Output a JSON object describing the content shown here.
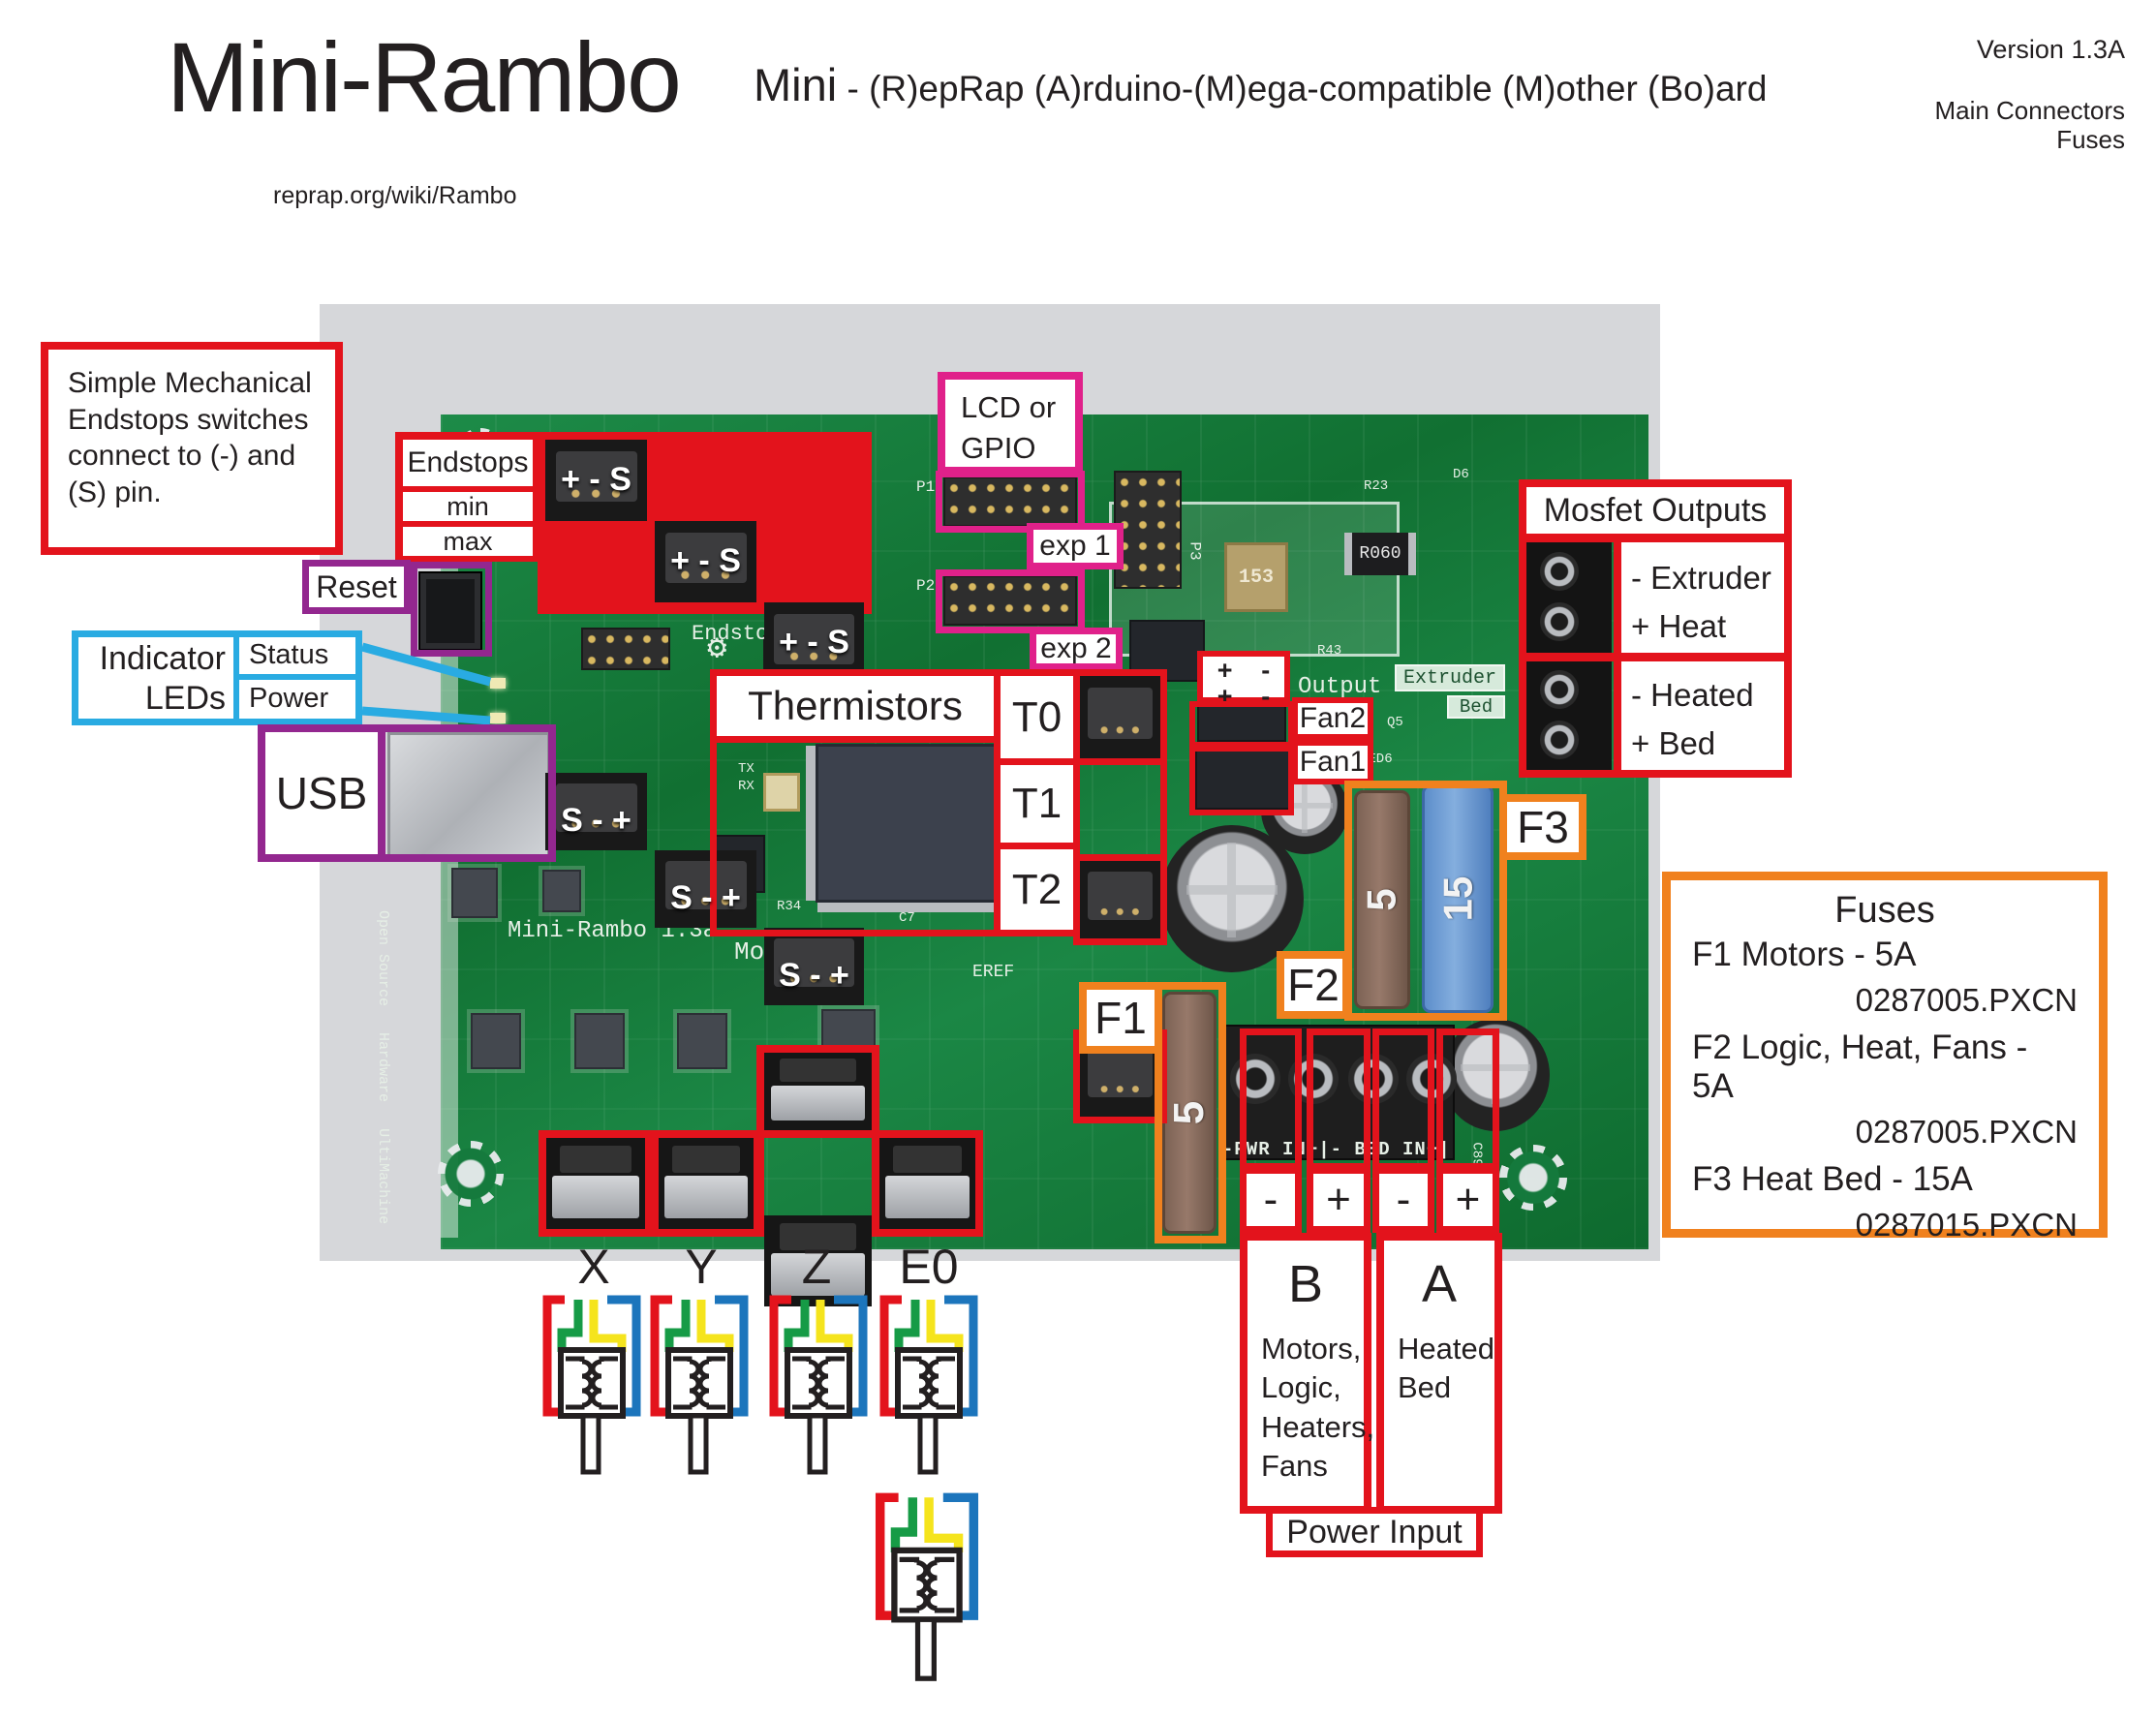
{
  "header": {
    "title": "Mini-Rambo",
    "url": "reprap.org/wiki/Rambo",
    "subtitle_lead": "Mini",
    "subtitle_rest": " - (R)epRap (A)rduino-(M)ega-compatible (M)other (Bo)ard",
    "version": "Version 1.3A",
    "corner_line1": "Main Connectors",
    "corner_line2": "Fuses"
  },
  "colors": {
    "annotation_red": "#e3131c",
    "annotation_pink": "#e0218a",
    "annotation_purple": "#93278f",
    "annotation_blue": "#29abe2",
    "annotation_orange": "#f0811e",
    "board_green": "#15793c",
    "wire_red": "#e3131c",
    "wire_green": "#169b46",
    "wire_yellow": "#f5e41d",
    "wire_blue": "#1c75bc"
  },
  "note": {
    "text": "Simple Mechanical Endstops switches connect to (-) and (S) pin."
  },
  "endstops": {
    "title": "Endstops",
    "row_min": "min",
    "row_max": "max",
    "pins_top": "+ - S",
    "pins_bottom": "S - +"
  },
  "lcd": {
    "line1": "LCD or",
    "line2": "GPIO",
    "exp1": "exp 1",
    "exp2": "exp 2"
  },
  "reset": {
    "label": "Reset"
  },
  "indicator": {
    "line1": "Indicator",
    "line2": "LEDs",
    "status": "Status",
    "power": "Power"
  },
  "usb": {
    "label": "USB"
  },
  "thermistors": {
    "title": "Thermistors",
    "t0": "T0",
    "t1": "T1",
    "t2": "T2"
  },
  "fans": {
    "fan1": "Fan1",
    "fan2": "Fan2",
    "plus": "+",
    "minus": "-"
  },
  "mosfet": {
    "title": "Mosfet Outputs",
    "row1_line1": "- Extruder",
    "row1_line2": "+ Heat",
    "row2_line1": "- Heated",
    "row2_line2": "+ Bed"
  },
  "fuse_tags": {
    "f1": "F1",
    "f2": "F2",
    "f3": "F3"
  },
  "fuses_legend": {
    "title": "Fuses",
    "items": [
      {
        "name": "F1 Motors - 5A",
        "part": "0287005.PXCN"
      },
      {
        "name": "F2 Logic, Heat, Fans - 5A",
        "part": "0287005.PXCN"
      },
      {
        "name": "F3 Heat Bed - 15A",
        "part": "0287015.PXCN"
      }
    ]
  },
  "motors": {
    "x": "X",
    "y": "Y",
    "z": "Z",
    "e0": "E0"
  },
  "power": {
    "sign1": "-",
    "sign2": "+",
    "sign3": "-",
    "sign4": "+",
    "b_label": "B",
    "b_desc": "Motors, Logic, Heaters, Fans",
    "a_label": "A",
    "a_desc": "Heated Bed",
    "title": "Power Input"
  },
  "board": {
    "silk": {
      "name": "Mini-Rambo 1.3a",
      "motors": "Motors",
      "output": "Output",
      "extruder": "Extruder",
      "bed": "Bed",
      "endstops": "Endstops",
      "eref": "EREF",
      "pwr_row": "-PWR IN+|- BED IN+|",
      "p1": "P1",
      "p2": "P2",
      "p3": "P3",
      "tx": "TX",
      "rx": "RX",
      "osh1": "Open Source",
      "osh2": "Hardware",
      "osh3": "UltiMachine",
      "r23": "R23",
      "d6": "D6",
      "r43": "R43",
      "c7": "C7",
      "r34": "R34",
      "c89": "C89",
      "led6": "LED6",
      "q5": "Q5",
      "r060": "R060",
      "c153": "153",
      "fuse_5": "5",
      "fuse_15": "15"
    }
  }
}
